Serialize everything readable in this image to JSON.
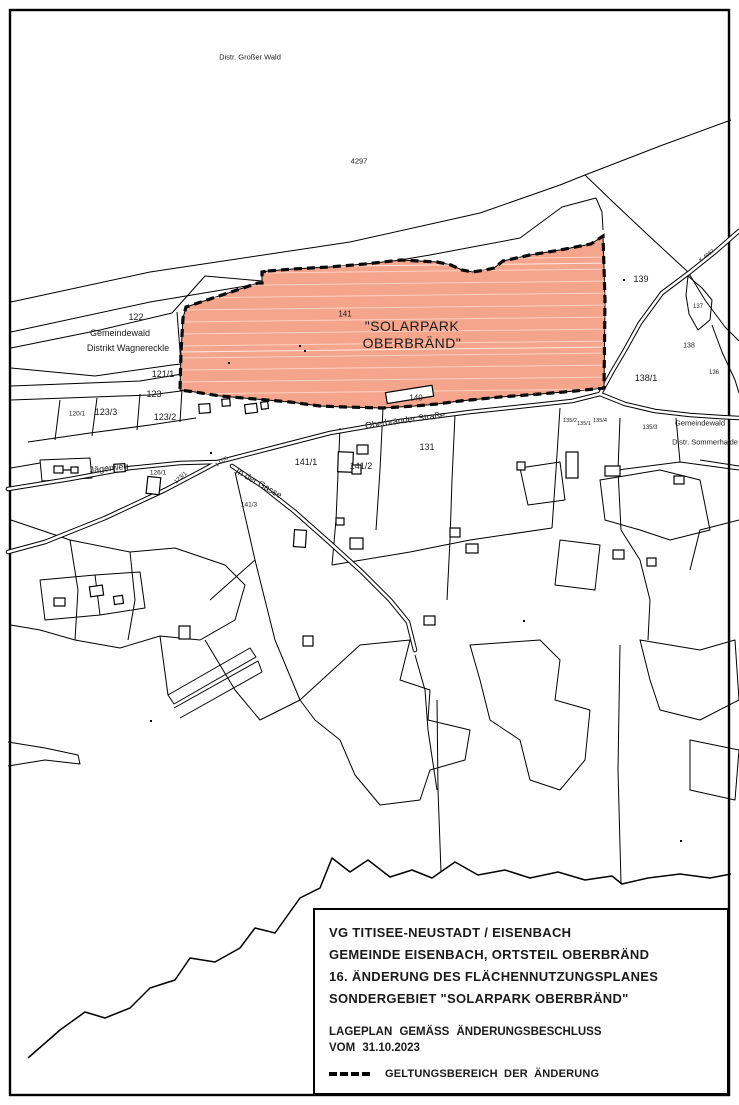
{
  "labels": {
    "distr_grosser_wald": "Distr. Großer Wald",
    "parcel_4297": "4297",
    "parcel_122": "122",
    "gemeindewald_left_1": "Gemeindewald",
    "gemeindewald_left_2": "Distrikt Wagnereckle",
    "parcel_121_1": "121/1",
    "parcel_123": "123",
    "parcel_120_1": "120/1",
    "parcel_123_3": "123/3",
    "parcel_123_2": "123/2",
    "parcel_141": "141",
    "solarpark_line1": "\"SOLARPARK",
    "solarpark_line2": "OBERBRÄND\"",
    "parcel_140": "140",
    "road_oberbraender": "Oberbränder Straße",
    "parcel_139": "139",
    "parcel_137": "137",
    "parcel_138": "138",
    "parcel_136": "136",
    "parcel_138_1": "138/1",
    "road_k": "K 4967",
    "parcel_135_2": "135/2",
    "parcel_135_1": "135/1",
    "parcel_135_4": "135/4",
    "parcel_135_3": "135/3",
    "gemeindewald_right_1": "Gemeindewald",
    "gemeindewald_right_2": "Distr. Sommerhalde",
    "road_jaegerweg": "Jägerweg",
    "parcel_126_1": "126/1",
    "parcel_123_1": "123/1",
    "parcel_141_6": "141/6",
    "road_in_der_gasse": "In der Gasse",
    "parcel_141_3": "141/3",
    "parcel_141_1": "141/1",
    "parcel_141_2": "141/2",
    "parcel_131": "131"
  },
  "title_block": {
    "line1": "VG TITISEE-NEUSTADT / EISENBACH",
    "line2": "GEMEINDE EISENBACH, ORTSTEIL OBERBRÄND",
    "line3": "16. ÄNDERUNG DES FLÄCHENNUTZUNGSPLANES",
    "line4": "SONDERGEBIET \"SOLARPARK OBERBRÄND\"",
    "subtitle1": "LAGEPLAN GEMÄSS ÄNDERUNGSBESCHLUSS",
    "subtitle2": "VOM 31.10.2023",
    "legend_label": "GELTUNGSBEREICH DER ÄNDERUNG"
  },
  "colors": {
    "plan_area_fill": "#F6A58D",
    "plan_area_hatch": "#FBD2C3",
    "line": "#000000",
    "background": "#FFFFFF"
  }
}
